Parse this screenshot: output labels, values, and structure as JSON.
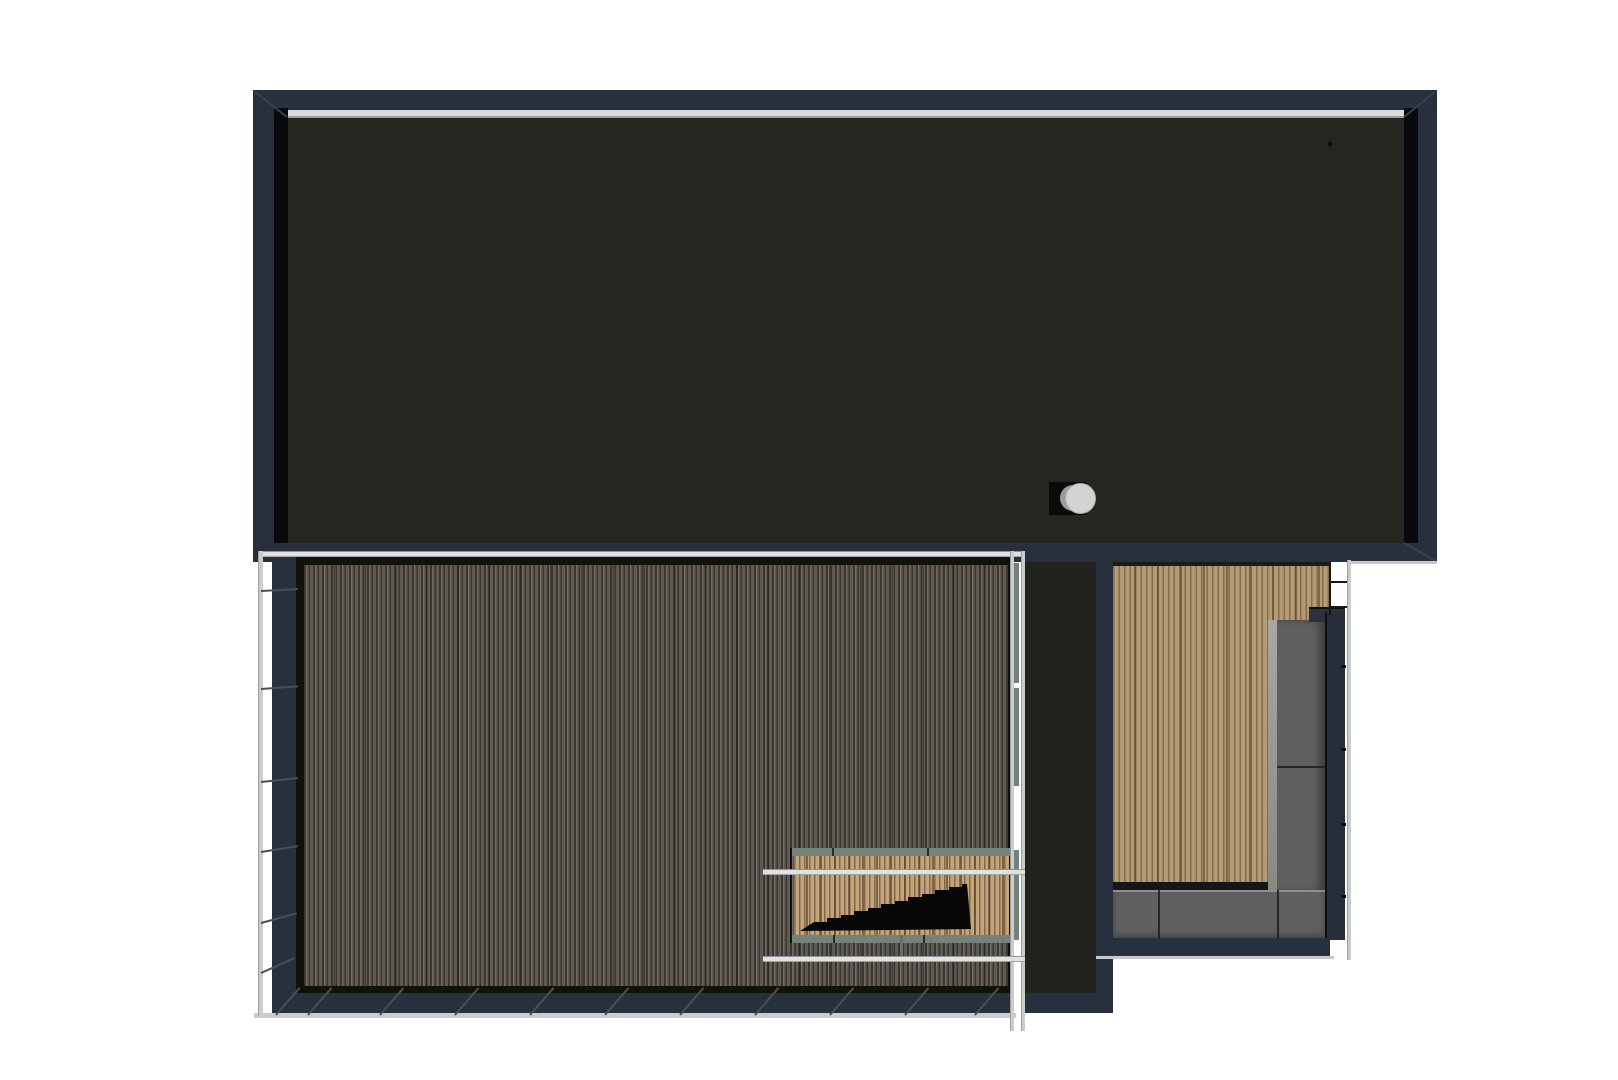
{
  "scene": {
    "description": "Top-down 3D architectural render of a modern flat-roof house with a dark roof slab, a striped lower wood terrace with stair opening and glass railing, and a right-hand wooden patio with built-in L-shaped corner sofa",
    "background": "#ffffff",
    "colors": {
      "background": "#ffffff",
      "frame_navy": "#28303d",
      "frame_black": "#07090c",
      "roof_surface": "#24261f",
      "fascia_highlight": "#d9dcdb",
      "deck_base": "#6f6a61",
      "deck_frame": "#111209",
      "stair_wood_base": "#c3a57b",
      "patio_wood_base": "#b59b73",
      "sofa_gray": "#606060",
      "sofa_edge_light": "#9a9a97",
      "band_sage": "#76817a",
      "railing_light": "#dfe2e1",
      "railing_shadow": "#8f9594",
      "stairs_black": "#070707",
      "vent_light": "#d3d4d1",
      "vent_shadow": "#9b9d99",
      "wall_dark": "#21241e",
      "baluster": "#4b4f4f"
    },
    "elements": [
      "roof-slab",
      "roof-fascia-frame",
      "roof-vent-cylinder",
      "lower-terrace-deck",
      "terrace-glass-railing",
      "stair-opening",
      "stairs-silhouette",
      "house-side-wall",
      "patio-wood-deck",
      "outdoor-corner-sofa",
      "patio-railing"
    ]
  }
}
